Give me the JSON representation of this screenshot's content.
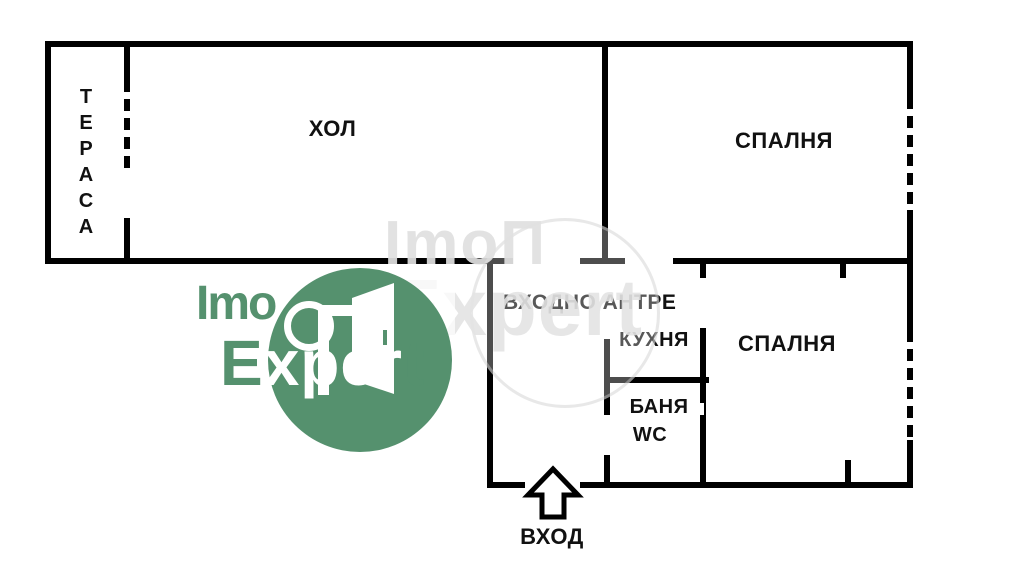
{
  "page": {
    "title": "Apartment floor plan",
    "background": "#ffffff"
  },
  "colors": {
    "wall": "#000000",
    "label": "#111111",
    "green": "#55916e"
  },
  "rooms": {
    "terrace": {
      "label": "ТЕРАСА",
      "letters": [
        "Т",
        "Е",
        "Р",
        "А",
        "С",
        "А"
      ]
    },
    "hall": {
      "label": "ХОЛ"
    },
    "bedroom1": {
      "label": "СПАЛНЯ"
    },
    "entry": {
      "label": "ВХОДНО АНТРЕ"
    },
    "kitchen": {
      "label": "КУХНЯ"
    },
    "bedroom2": {
      "label": "СПАЛНЯ"
    },
    "bath": {
      "line1": "БАНЯ",
      "line2": "WC"
    }
  },
  "entrance": {
    "label": "ВХОД"
  },
  "watermark": {
    "brand_line1": "Imo",
    "brand_line2": {
      "e": "E",
      "xper": "xper",
      "t": "t"
    },
    "ghost_line1": "ImoΠ",
    "ghost_line2": "Expert"
  }
}
